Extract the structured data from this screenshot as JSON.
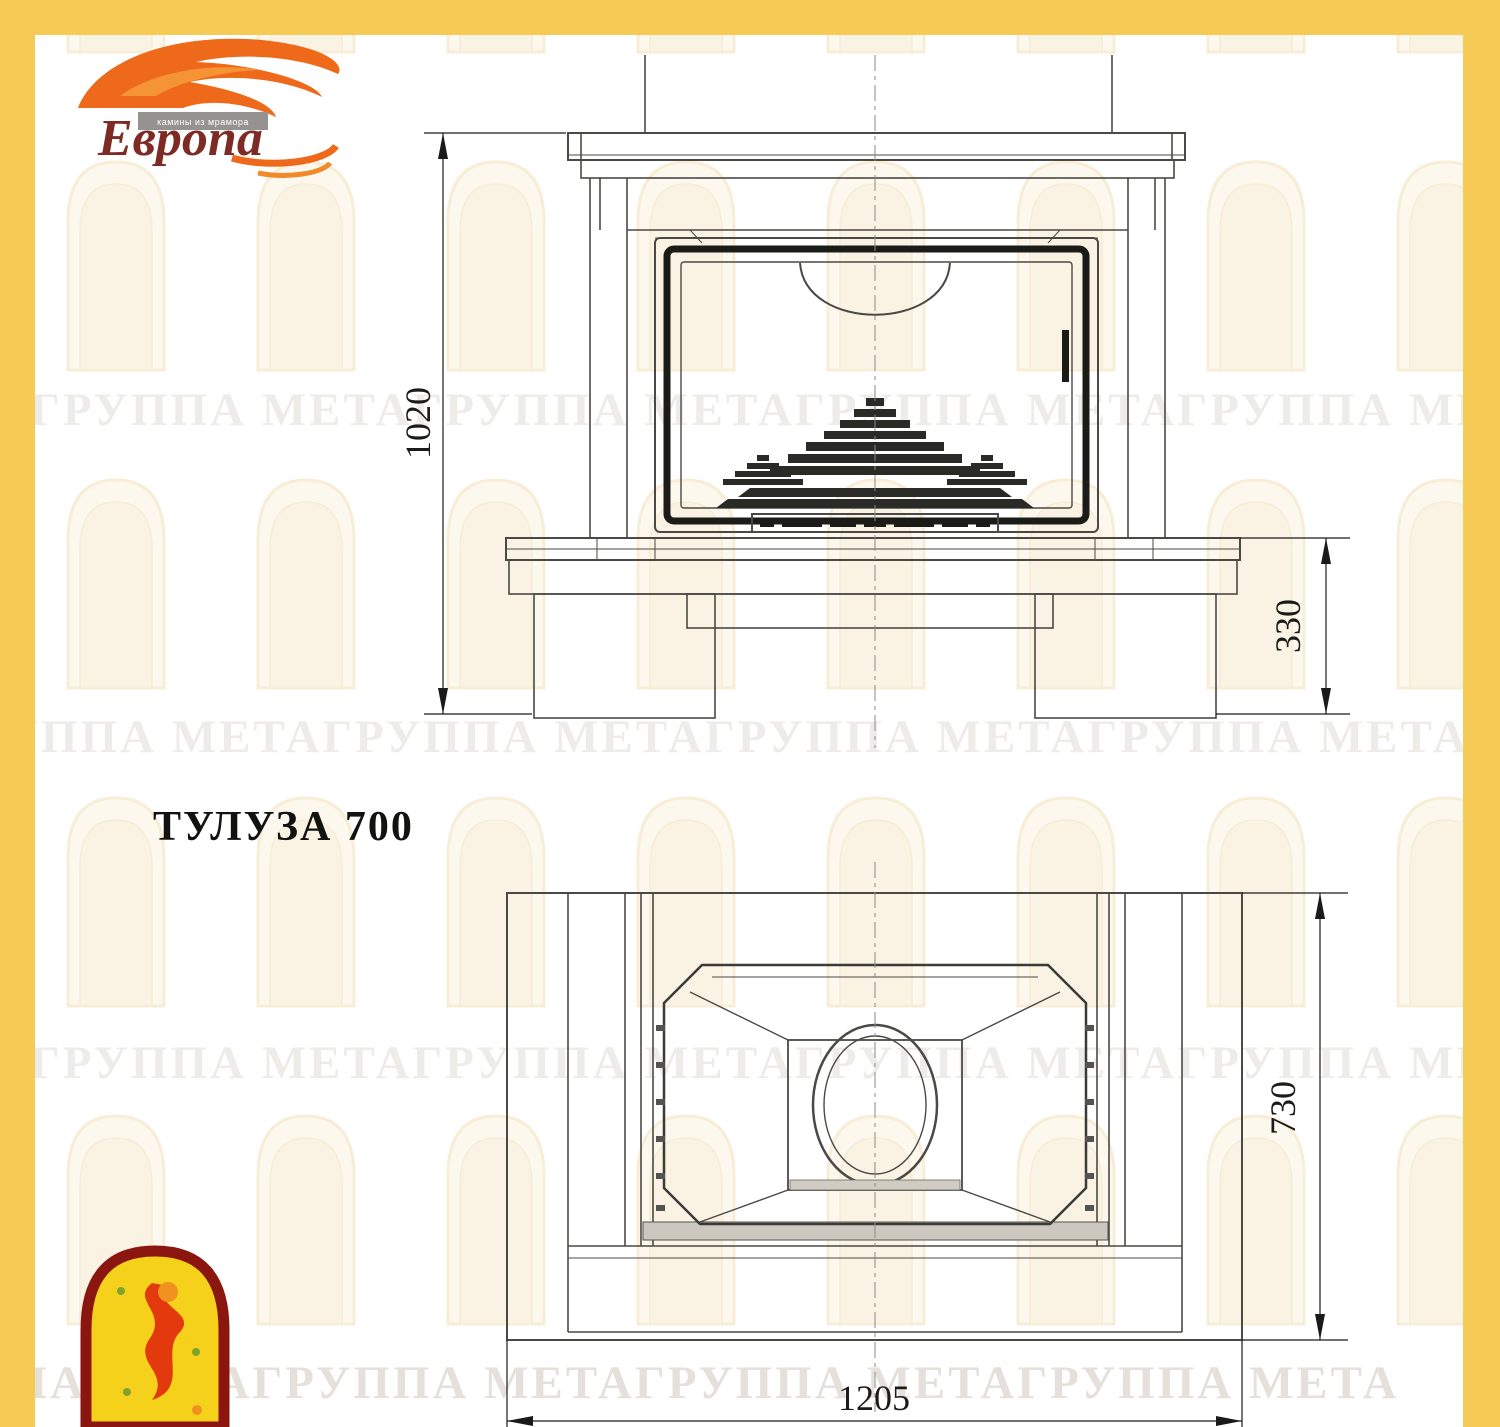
{
  "page": {
    "background": "#FFFFFF",
    "border_color": "#F5CB56",
    "line_color": "#4B4945",
    "heavy_line_color": "#1B1B18",
    "accent_orange": "#EE6A1A",
    "logo_text_color": "#7D2B24",
    "emblem_red": "#8B150F",
    "emblem_yellow": "#F6D11C"
  },
  "brand": {
    "name": "Европа",
    "tagline": "камины из мрамора"
  },
  "title": "ТУЛУЗА 700",
  "watermark": {
    "text": "ГРУППА МЕТАГРУППА МЕТАГРУППА МЕТАГРУППА МЕТА"
  },
  "drawing": {
    "front_view": {
      "label": "front view",
      "height_mm": "1020",
      "base_height_mm": "330"
    },
    "plan_view": {
      "label": "plan view",
      "depth_mm": "730",
      "width_mm": "1205"
    }
  }
}
